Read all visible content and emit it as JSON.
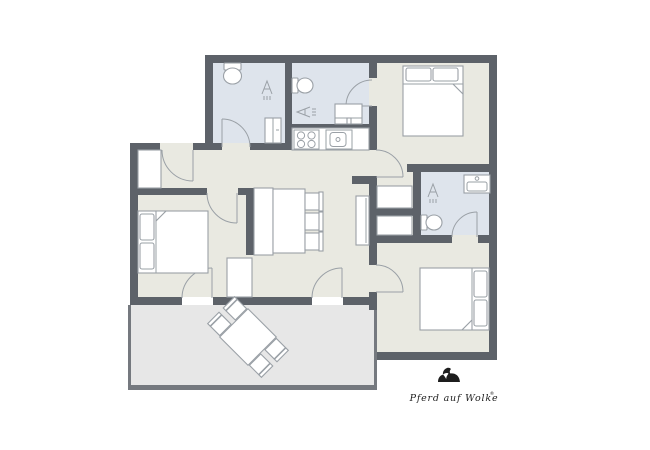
{
  "logo": {
    "brand": "Pferd auf Wolke",
    "mark": "®"
  },
  "colors": {
    "background": "#ffffff",
    "wall": "#5d6269",
    "terrace_wall": "#75797f",
    "floor_main": "#e9e9e1",
    "floor_bath": "#dee4ec",
    "floor_terrace": "#e7e7e7",
    "furniture_stroke": "#9aa0a6",
    "logo_ink": "#1d1d1d"
  },
  "icons": {
    "shower": "triangle-with-spray-lines",
    "toilet": "bowl-with-cistern",
    "washbasin": "basin-with-faucet",
    "stove": "four-burner-cooktop",
    "kitchen_sink": "basin-with-tap-dot",
    "double_bed": "bed-with-two-pillows-and-folded-blanket",
    "wardrobe": "white-rectangle-cabinet",
    "dining_chair": "seat-with-backrest",
    "door": "quarter-circle-swing-arc",
    "logo_horse": "horse-silhouette"
  }
}
